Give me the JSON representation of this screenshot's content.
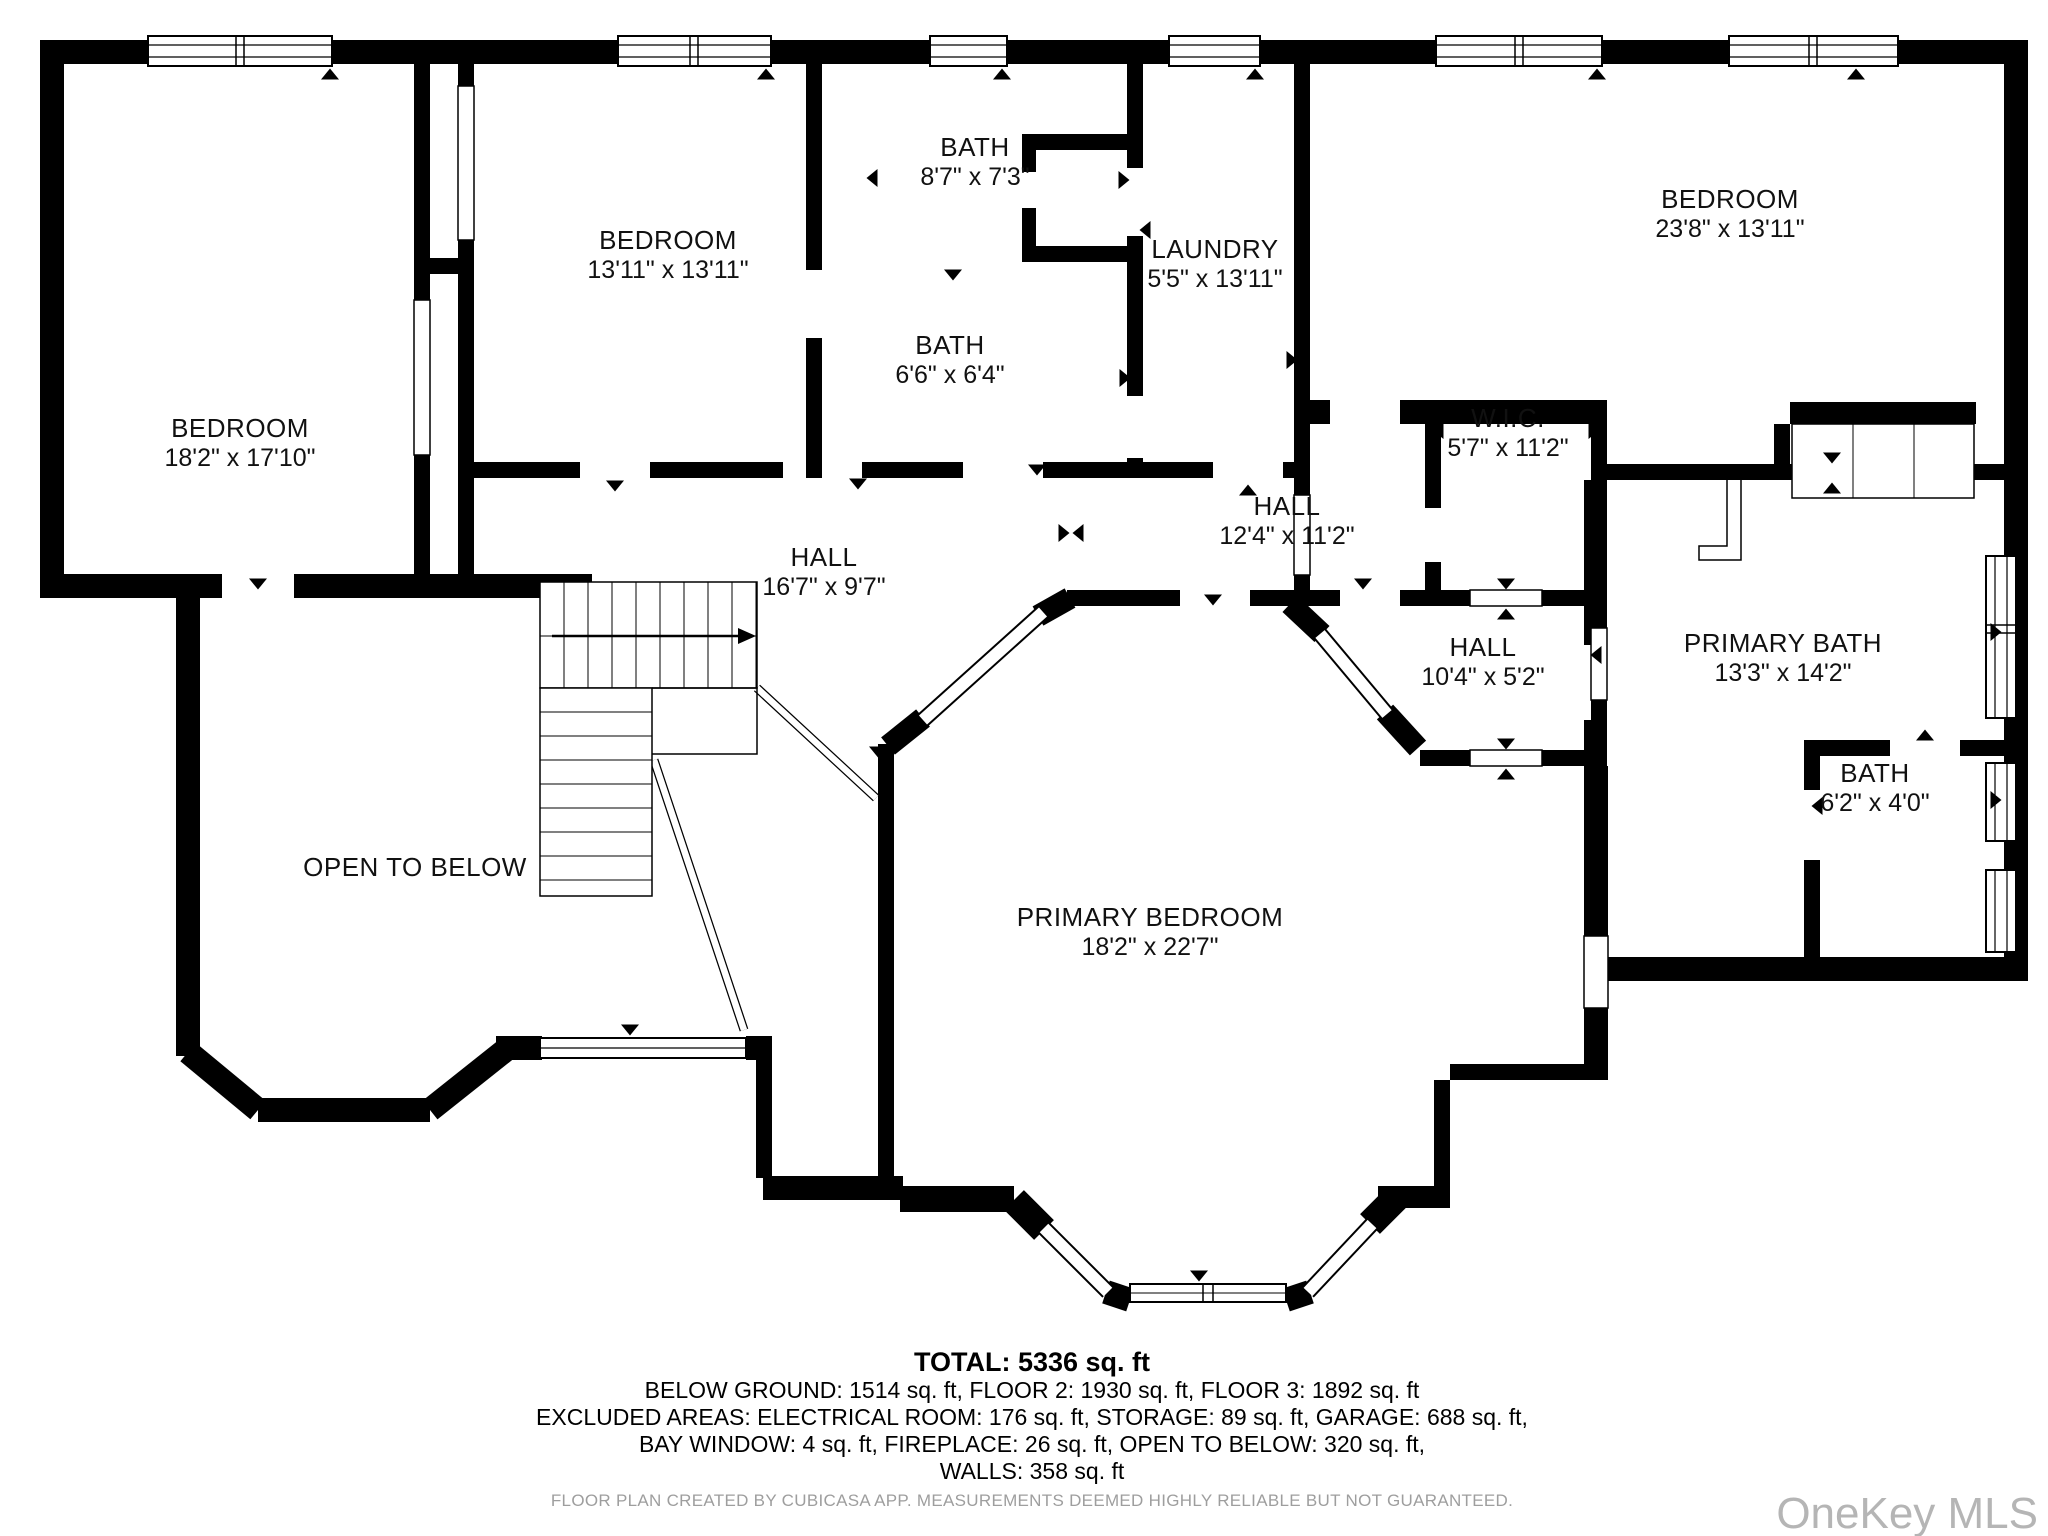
{
  "plan": {
    "title": "Floor plan - Floor 3",
    "rooms": [
      {
        "name": "BEDROOM",
        "dims": "18'2\" x 17'10\"",
        "x": 240,
        "y": 441
      },
      {
        "name": "BEDROOM",
        "dims": "13'11\" x 13'11\"",
        "x": 668,
        "y": 253
      },
      {
        "name": "BATH",
        "dims": "8'7\" x 7'3\"",
        "x": 975,
        "y": 160
      },
      {
        "name": "LAUNDRY",
        "dims": "5'5\" x 13'11\"",
        "x": 1215,
        "y": 262
      },
      {
        "name": "BEDROOM",
        "dims": "23'8\" x 13'11\"",
        "x": 1730,
        "y": 212
      },
      {
        "name": "BATH",
        "dims": "6'6\" x 6'4\"",
        "x": 950,
        "y": 358
      },
      {
        "name": "W.I.C.",
        "dims": "5'7\" x 11'2\"",
        "x": 1508,
        "y": 431
      },
      {
        "name": "HALL",
        "dims": "12'4\" x 11'2\"",
        "x": 1287,
        "y": 519
      },
      {
        "name": "HALL",
        "dims": "16'7\" x 9'7\"",
        "x": 824,
        "y": 570
      },
      {
        "name": "HALL",
        "dims": "10'4\" x 5'2\"",
        "x": 1483,
        "y": 660
      },
      {
        "name": "PRIMARY BATH",
        "dims": "13'3\" x 14'2\"",
        "x": 1783,
        "y": 656
      },
      {
        "name": "BATH",
        "dims": "6'2\" x 4'0\"",
        "x": 1875,
        "y": 786
      },
      {
        "name": "OPEN TO BELOW",
        "dims": null,
        "x": 415,
        "y": 870
      },
      {
        "name": "PRIMARY BEDROOM",
        "dims": "18'2\" x 22'7\"",
        "x": 1150,
        "y": 930
      }
    ],
    "summary": {
      "total": "TOTAL: 5336 sq. ft",
      "lines": [
        "BELOW GROUND: 1514 sq. ft, FLOOR 2: 1930 sq. ft, FLOOR 3: 1892 sq. ft",
        "EXCLUDED AREAS: ELECTRICAL ROOM: 176 sq. ft, STORAGE: 89 sq. ft, GARAGE: 688 sq. ft,",
        "BAY WINDOW: 4 sq. ft, FIREPLACE: 26 sq. ft, OPEN TO BELOW: 320 sq. ft,",
        "WALLS: 358 sq. ft"
      ]
    },
    "disclaimer": "FLOOR PLAN CREATED BY CUBICASA APP. MEASUREMENTS DEEMED HIGHLY RELIABLE BUT NOT GUARANTEED.",
    "watermark": "OneKey MLS",
    "colors": {
      "wall": "#000000",
      "disclaimer": "#9e9e9e",
      "watermark": "#b5b5b5"
    }
  }
}
